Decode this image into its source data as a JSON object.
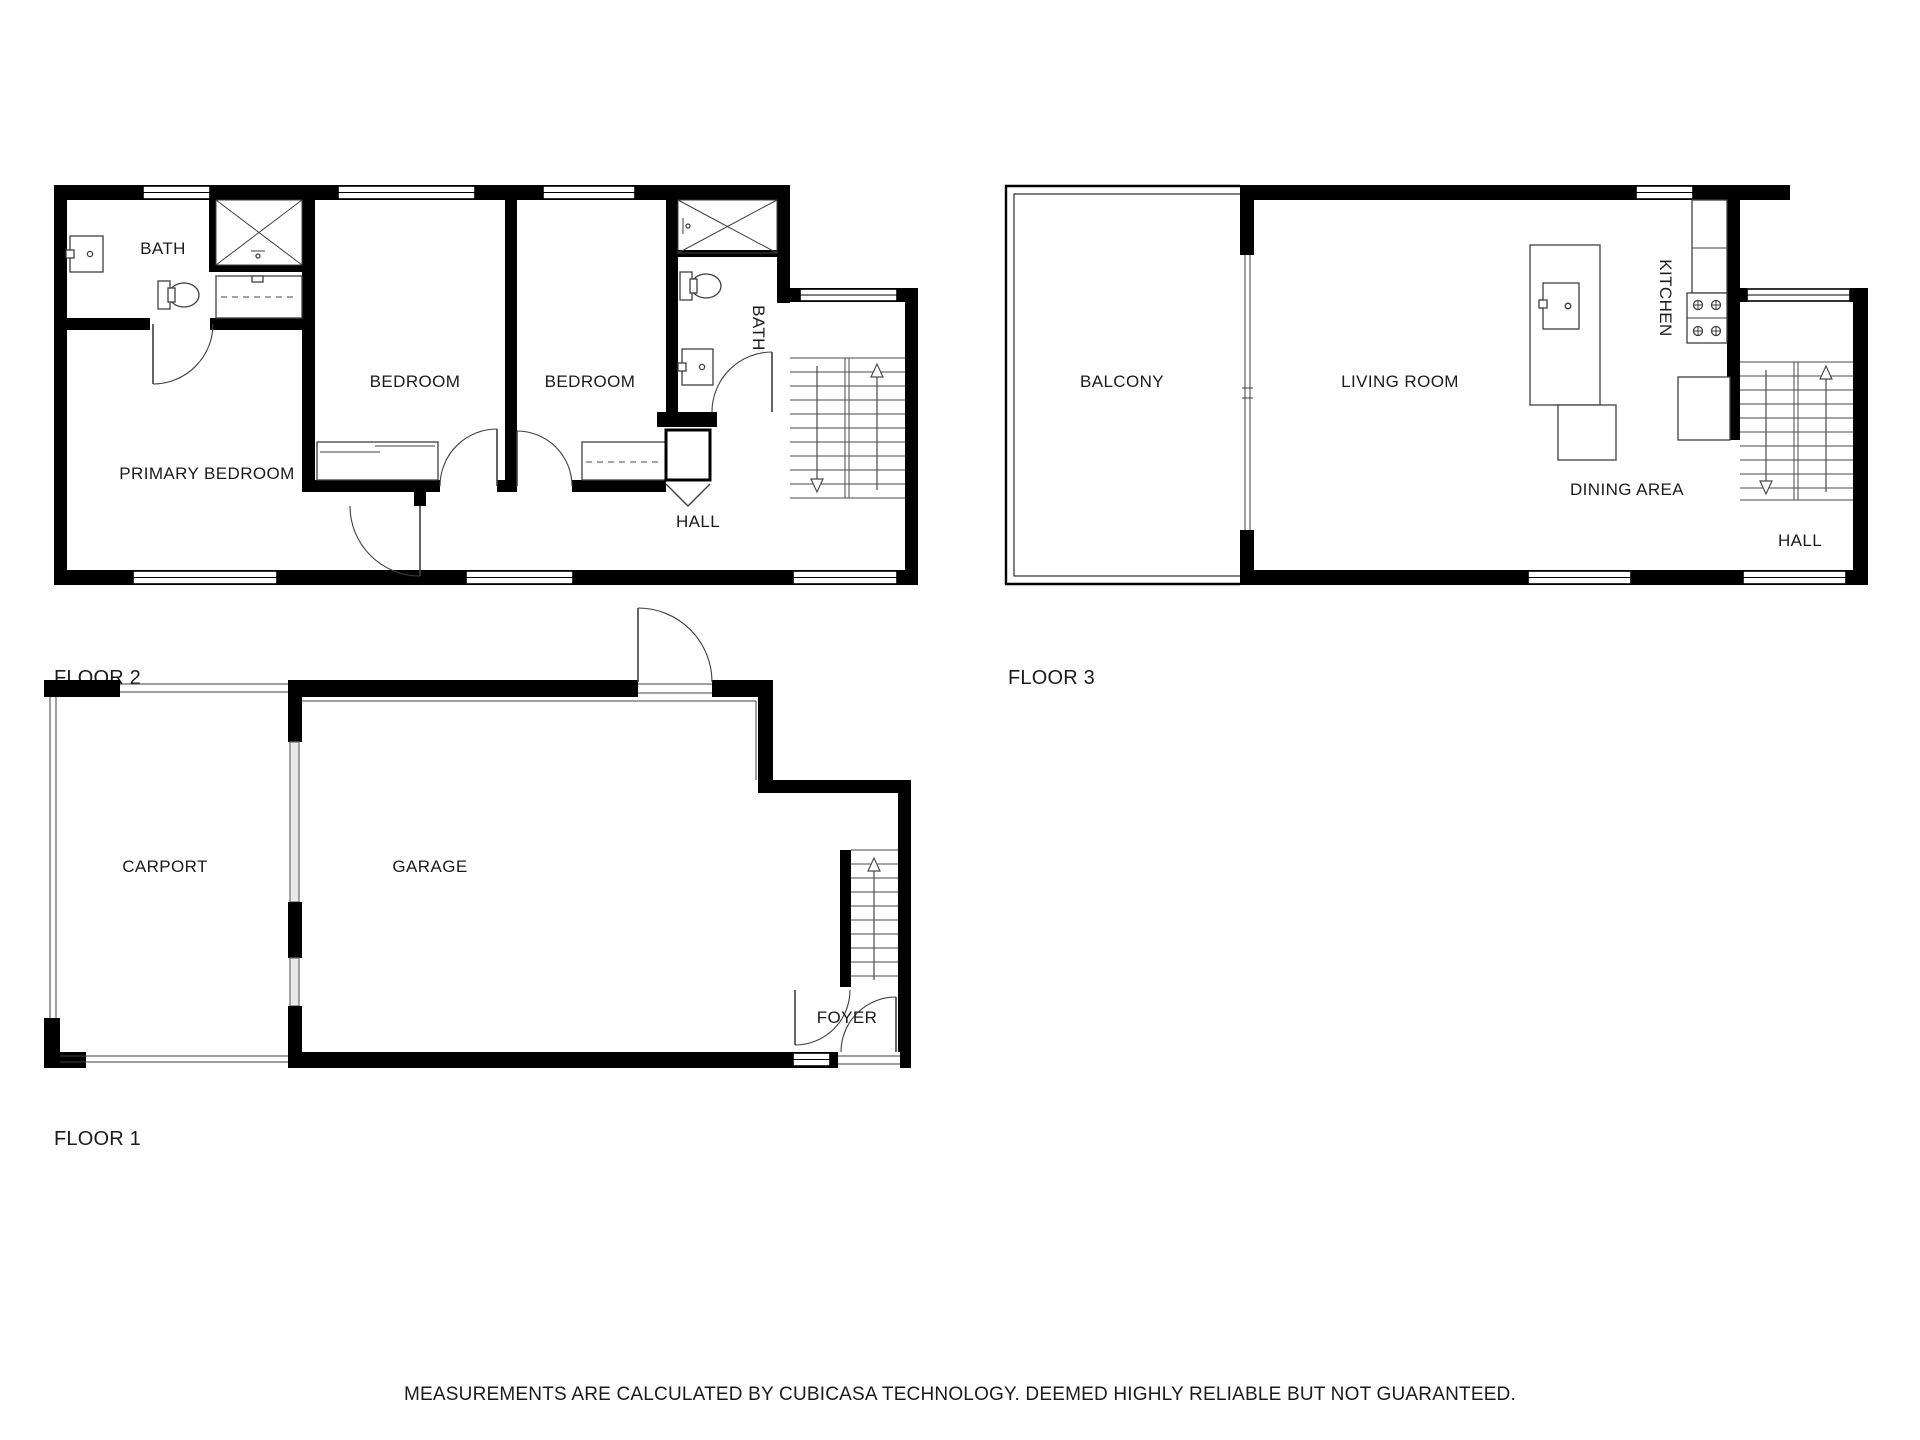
{
  "colors": {
    "wall": "#000000",
    "background": "#ffffff",
    "fixture_line": "#3f3f3f"
  },
  "floor2": {
    "label": "FLOOR 2",
    "rooms": {
      "bath1": "BATH",
      "bedroom1": "BEDROOM",
      "bedroom2": "BEDROOM",
      "bath2": "BATH",
      "primary_bedroom": "PRIMARY BEDROOM",
      "hall": "HALL"
    }
  },
  "floor3": {
    "label": "FLOOR 3",
    "rooms": {
      "balcony": "BALCONY",
      "living_room": "LIVING ROOM",
      "kitchen": "KITCHEN",
      "dining_area": "DINING AREA",
      "hall": "HALL"
    }
  },
  "floor1": {
    "label": "FLOOR 1",
    "rooms": {
      "carport": "CARPORT",
      "garage": "GARAGE",
      "foyer": "FOYER"
    }
  },
  "disclaimer": "MEASUREMENTS ARE CALCULATED BY CUBICASA TECHNOLOGY. DEEMED HIGHLY RELIABLE BUT NOT GUARANTEED."
}
